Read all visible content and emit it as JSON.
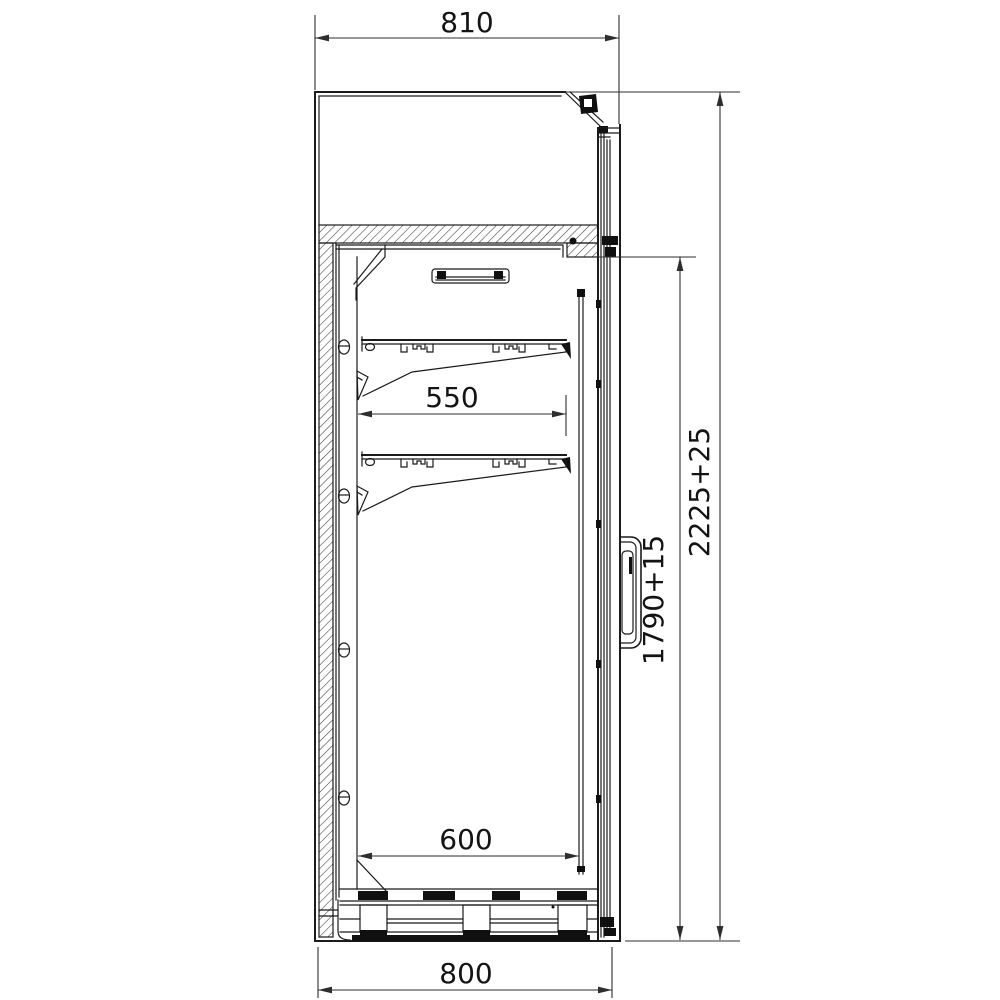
{
  "drawing": {
    "type": "technical-section",
    "colors": {
      "background": "#ffffff",
      "line": "#1b1b1b",
      "dimension": "#2e2e2e"
    },
    "dimensions": {
      "top_width": "810",
      "shelf_depth": "550",
      "interior_depth": "600",
      "base_width": "800",
      "overall_height": "2225+25",
      "interior_height": "1790+15"
    }
  }
}
